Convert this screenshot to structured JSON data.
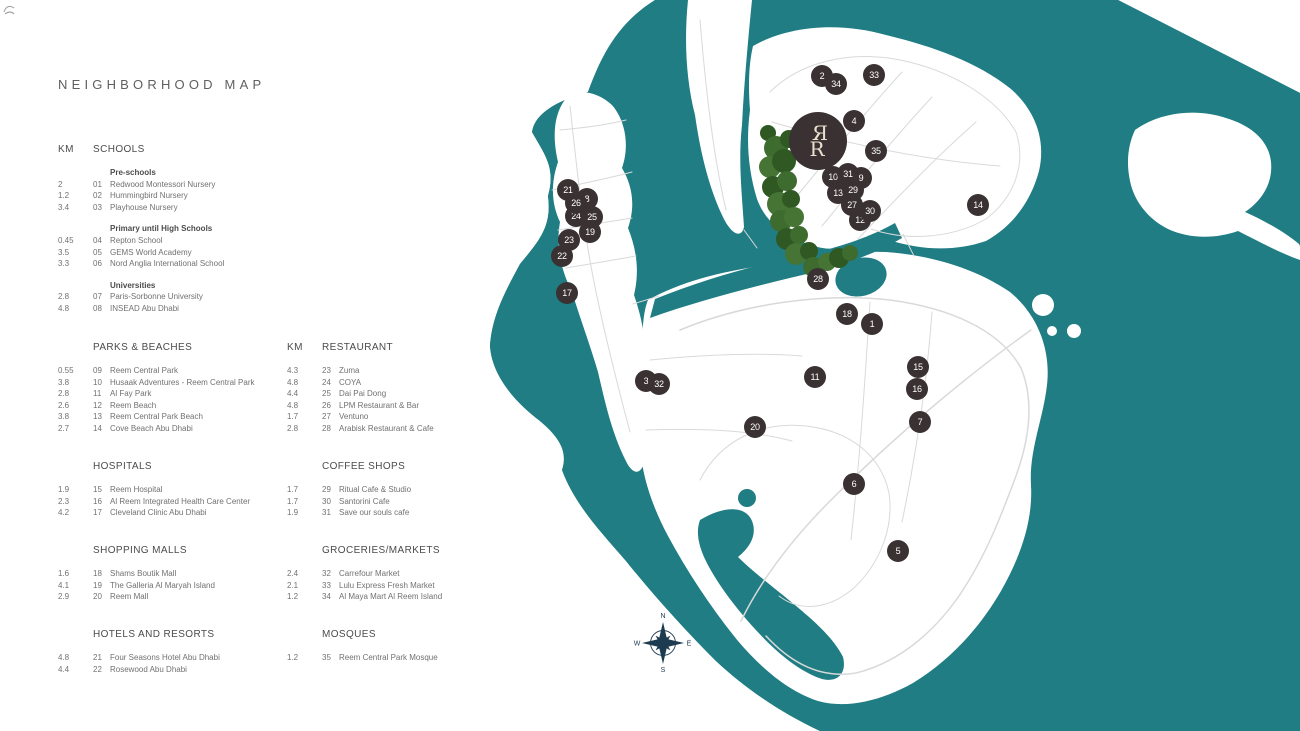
{
  "page": {
    "title": "NEIGHBORHOOD MAP"
  },
  "legend": {
    "km_label": "KM",
    "columns": [
      {
        "sections": [
          {
            "header": "SCHOOLS",
            "show_km": true,
            "groups": [
              {
                "label": "Pre-schools",
                "items": [
                  {
                    "km": "2",
                    "num": "01",
                    "name": "Redwood Montessori Nursery"
                  },
                  {
                    "km": "1.2",
                    "num": "02",
                    "name": "Hummingbird Nursery"
                  },
                  {
                    "km": "3.4",
                    "num": "03",
                    "name": "Playhouse Nursery"
                  }
                ]
              },
              {
                "label": "Primary until High Schools",
                "items": [
                  {
                    "km": "0.45",
                    "num": "04",
                    "name": "Repton School"
                  },
                  {
                    "km": "3.5",
                    "num": "05",
                    "name": "GEMS World Academy"
                  },
                  {
                    "km": "3.3",
                    "num": "06",
                    "name": "Nord Anglia International School"
                  }
                ]
              },
              {
                "label": "Universities",
                "items": [
                  {
                    "km": "2.8",
                    "num": "07",
                    "name": "Paris-Sorbonne University"
                  },
                  {
                    "km": "4.8",
                    "num": "08",
                    "name": "INSEAD Abu Dhabi"
                  }
                ]
              }
            ]
          },
          {
            "header": "PARKS & BEACHES",
            "show_km": false,
            "groups": [
              {
                "label": "",
                "items": [
                  {
                    "km": "0.55",
                    "num": "09",
                    "name": "Reem Central Park"
                  },
                  {
                    "km": "3.8",
                    "num": "10",
                    "name": "Husaak Adventures - Reem Central Park"
                  },
                  {
                    "km": "2.8",
                    "num": "11",
                    "name": "Al Fay Park"
                  },
                  {
                    "km": "2.6",
                    "num": "12",
                    "name": "Reem Beach"
                  },
                  {
                    "km": "3.8",
                    "num": "13",
                    "name": "Reem Central Park Beach"
                  },
                  {
                    "km": "2.7",
                    "num": "14",
                    "name": "Cove Beach Abu Dhabi"
                  }
                ]
              }
            ]
          },
          {
            "header": "HOSPITALS",
            "show_km": false,
            "groups": [
              {
                "label": "",
                "items": [
                  {
                    "km": "1.9",
                    "num": "15",
                    "name": "Reem Hospital"
                  },
                  {
                    "km": "2.3",
                    "num": "16",
                    "name": "Al Reem Integrated Health Care Center"
                  },
                  {
                    "km": "4.2",
                    "num": "17",
                    "name": "Cleveland Clinic Abu Dhabi"
                  }
                ]
              }
            ]
          },
          {
            "header": "SHOPPING MALLS",
            "show_km": false,
            "groups": [
              {
                "label": "",
                "items": [
                  {
                    "km": "1.6",
                    "num": "18",
                    "name": "Shams Boutik Mall"
                  },
                  {
                    "km": "4.1",
                    "num": "19",
                    "name": "The Galleria Al Maryah Island"
                  },
                  {
                    "km": "2.9",
                    "num": "20",
                    "name": "Reem Mall"
                  }
                ]
              }
            ]
          },
          {
            "header": "HOTELS AND RESORTS",
            "show_km": false,
            "groups": [
              {
                "label": "",
                "items": [
                  {
                    "km": "4.8",
                    "num": "21",
                    "name": "Four Seasons Hotel Abu Dhabi"
                  },
                  {
                    "km": "4.4",
                    "num": "22",
                    "name": "Rosewood Abu Dhabi"
                  }
                ]
              }
            ]
          }
        ]
      },
      {
        "sections": [
          {
            "header": "RESTAURANT",
            "show_km": true,
            "groups": [
              {
                "label": "",
                "items": [
                  {
                    "km": "4.3",
                    "num": "23",
                    "name": "Zuma"
                  },
                  {
                    "km": "4.8",
                    "num": "24",
                    "name": "COYA"
                  },
                  {
                    "km": "4.4",
                    "num": "25",
                    "name": "Dai Pai Dong"
                  },
                  {
                    "km": "4.8",
                    "num": "26",
                    "name": "LPM Restaurant & Bar"
                  },
                  {
                    "km": "1.7",
                    "num": "27",
                    "name": "Ventuno"
                  },
                  {
                    "km": "2.8",
                    "num": "28",
                    "name": "Arabisk Restaurant & Cafe"
                  }
                ]
              }
            ]
          },
          {
            "header": "COFFEE SHOPS",
            "show_km": false,
            "groups": [
              {
                "label": "",
                "items": [
                  {
                    "km": "1.7",
                    "num": "29",
                    "name": "Ritual Cafe & Studio"
                  },
                  {
                    "km": "1.7",
                    "num": "30",
                    "name": "Santorini Cafe"
                  },
                  {
                    "km": "1.9",
                    "num": "31",
                    "name": "Save our souls cafe"
                  }
                ]
              }
            ]
          },
          {
            "header": "GROCERIES/MARKETS",
            "show_km": false,
            "groups": [
              {
                "label": "",
                "items": [
                  {
                    "km": "2.4",
                    "num": "32",
                    "name": "Carrefour Market"
                  },
                  {
                    "km": "2.1",
                    "num": "33",
                    "name": "Lulu Express Fresh Market"
                  },
                  {
                    "km": "1.2",
                    "num": "34",
                    "name": "Al Maya Mart Al Reem Island"
                  }
                ]
              }
            ]
          },
          {
            "header": "MOSQUES",
            "show_km": false,
            "groups": [
              {
                "label": "",
                "items": [
                  {
                    "km": "1.2",
                    "num": "35",
                    "name": "Reem Central Park Mosque"
                  }
                ]
              }
            ]
          }
        ]
      }
    ]
  },
  "map": {
    "markers": [
      {
        "num": "1",
        "x": 872,
        "y": 324
      },
      {
        "num": "2",
        "x": 822,
        "y": 76
      },
      {
        "num": "3",
        "x": 646,
        "y": 381
      },
      {
        "num": "4",
        "x": 854,
        "y": 121
      },
      {
        "num": "5",
        "x": 898,
        "y": 551
      },
      {
        "num": "6",
        "x": 854,
        "y": 484
      },
      {
        "num": "7",
        "x": 920,
        "y": 422
      },
      {
        "num": "8",
        "x": 587,
        "y": 199
      },
      {
        "num": "9",
        "x": 861,
        "y": 178
      },
      {
        "num": "10",
        "x": 833,
        "y": 177
      },
      {
        "num": "11",
        "x": 815,
        "y": 377
      },
      {
        "num": "12",
        "x": 860,
        "y": 220
      },
      {
        "num": "13",
        "x": 838,
        "y": 193
      },
      {
        "num": "14",
        "x": 978,
        "y": 205
      },
      {
        "num": "15",
        "x": 918,
        "y": 367
      },
      {
        "num": "16",
        "x": 917,
        "y": 389
      },
      {
        "num": "17",
        "x": 567,
        "y": 293
      },
      {
        "num": "18",
        "x": 847,
        "y": 314
      },
      {
        "num": "19",
        "x": 590,
        "y": 232
      },
      {
        "num": "20",
        "x": 755,
        "y": 427
      },
      {
        "num": "21",
        "x": 568,
        "y": 190
      },
      {
        "num": "22",
        "x": 562,
        "y": 256
      },
      {
        "num": "23",
        "x": 569,
        "y": 240
      },
      {
        "num": "24",
        "x": 576,
        "y": 216
      },
      {
        "num": "25",
        "x": 592,
        "y": 217
      },
      {
        "num": "26",
        "x": 576,
        "y": 203
      },
      {
        "num": "27",
        "x": 852,
        "y": 205
      },
      {
        "num": "28",
        "x": 818,
        "y": 279
      },
      {
        "num": "29",
        "x": 853,
        "y": 190
      },
      {
        "num": "30",
        "x": 870,
        "y": 211
      },
      {
        "num": "31",
        "x": 848,
        "y": 174
      },
      {
        "num": "32",
        "x": 659,
        "y": 384
      },
      {
        "num": "33",
        "x": 874,
        "y": 75
      },
      {
        "num": "34",
        "x": 836,
        "y": 84
      },
      {
        "num": "35",
        "x": 876,
        "y": 151
      }
    ],
    "logo": {
      "x": 818,
      "y": 141,
      "monogram_top": "Я",
      "monogram_bottom": "R"
    },
    "compass": {
      "x": 663,
      "y": 643,
      "n": "N",
      "e": "E",
      "s": "S",
      "w": "W"
    },
    "colors": {
      "sea": "#1f7d83",
      "land": "#ffffff",
      "road": "#d9d9d9",
      "marker": "#3a3133",
      "marker_text": "#ffffff",
      "compass": "#1c3a50",
      "tree1": "#3e6b2e",
      "tree2": "#2f5823",
      "tree3": "#467434",
      "monogram": "#e9e0cf"
    }
  }
}
